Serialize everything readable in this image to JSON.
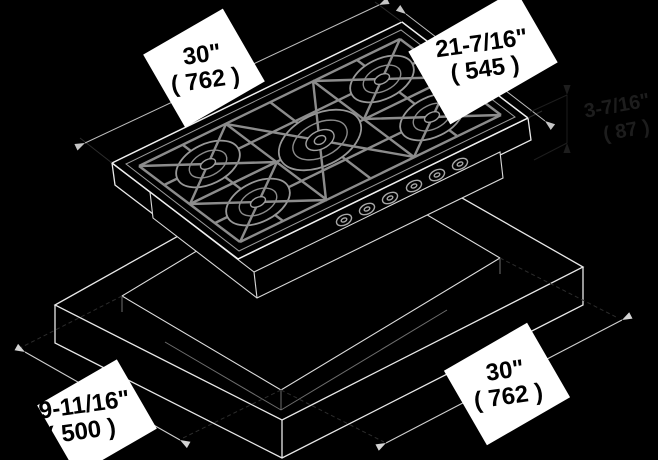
{
  "diagram": {
    "description": "isometric installation diagram of a 5-burner gas cooktop above a countertop cutout",
    "labels": {
      "cooktop_width": {
        "value": "30\"",
        "metric": "( 762 )"
      },
      "cooktop_depth": {
        "value": "21-7/16\"",
        "metric": "( 545 )"
      },
      "body_height": {
        "value": "3-7/16\"",
        "metric": "( 87 )"
      },
      "cutout_depth": {
        "value": "19-11/16\"",
        "metric": "( 500 )"
      },
      "cutout_width": {
        "value": "30\"",
        "metric": "( 762 )"
      }
    },
    "colors": {
      "background": "#000000",
      "outline": "#e8e8e8",
      "grate": "#8c8c8c",
      "dimension_line": "#c9c9c9",
      "extension_line": "#2c2c2c",
      "hidden_text": "#1d1d1d",
      "label_background": "#ffffff",
      "label_text": "#000000"
    }
  }
}
